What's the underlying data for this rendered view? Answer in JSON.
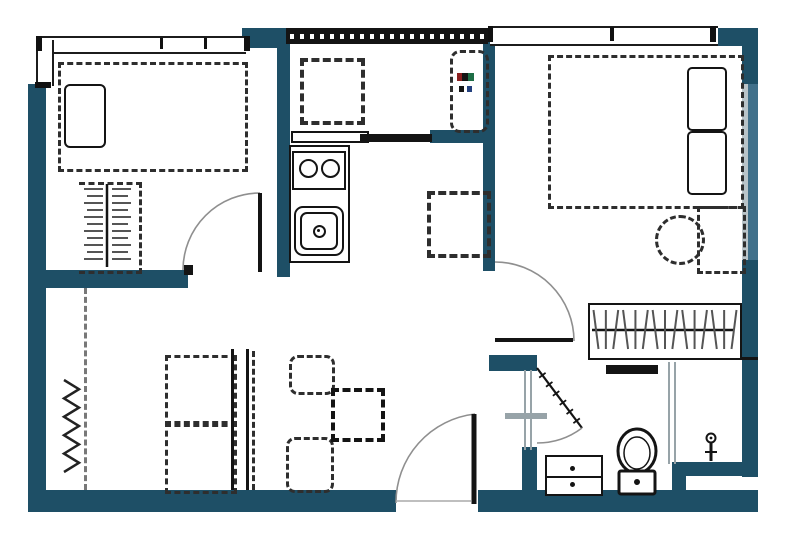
{
  "document": {
    "kind": "floor-plan"
  },
  "colors": {
    "wall": "#1e4f66",
    "wall_window_band": "#41708a",
    "window_glass": "#b9c4c9",
    "line": "#141414",
    "furniture_dash": "#2e2e2e",
    "soft_gray": "#97a3a8",
    "door_arc": "#8f8f8f",
    "heater_red": "#8b1f1f",
    "heater_green": "#1e6e46",
    "heater_blue": "#24407e",
    "background": "#ffffff"
  },
  "rooms": [
    {
      "name": "bedroom-top-left",
      "furniture": [
        "single-bed",
        "pillow",
        "closet-with-hangers",
        "hinged-door"
      ]
    },
    {
      "name": "balcony",
      "furniture": [
        "washing-machine",
        "water-heater-unit",
        "louvered-railing",
        "sliding-door"
      ]
    },
    {
      "name": "kitchen",
      "furniture": [
        "counter",
        "two-burner-cooktop",
        "kitchen-sink",
        "refrigerator"
      ]
    },
    {
      "name": "bedroom-right",
      "furniture": [
        "double-bed",
        "pillow",
        "pillow",
        "round-stool",
        "desk",
        "wardrobe-with-hangers",
        "hinged-door"
      ]
    },
    {
      "name": "living-dining",
      "furniture": [
        "sofa-seats",
        "sofa-back",
        "dining-table",
        "dining-chair",
        "dining-chair",
        "coat-rack",
        "entry-door"
      ]
    },
    {
      "name": "bathroom",
      "furniture": [
        "vanity-sink",
        "toilet",
        "shower-screen",
        "shower-mixer",
        "hinged-door",
        "towel-bar"
      ]
    }
  ],
  "openings": {
    "hinged_doors": 4,
    "sliding_doors": 1,
    "windows": 4,
    "louvered_openings": 1
  },
  "details": {
    "wardrobe_hanger_count": 15,
    "closet_hatch_rows": 11,
    "bathroom_door_hatch_count": 6,
    "coatrack_zigzag_segments": 10
  }
}
